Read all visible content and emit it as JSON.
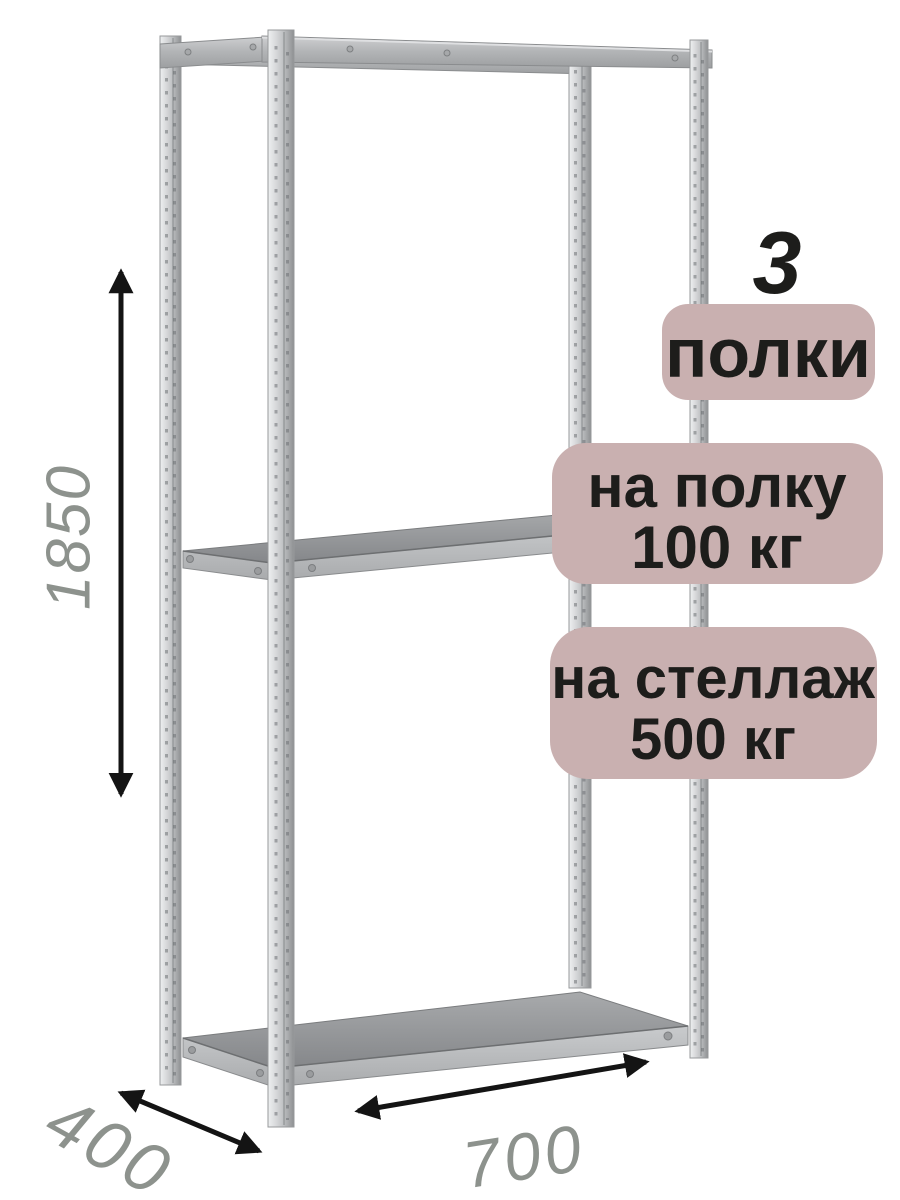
{
  "badges": {
    "count_number": "3",
    "count_label": "полки",
    "shelf_load_line1": "на полку",
    "shelf_load_line2": "100 кг",
    "rack_load_line1": "на стеллаж",
    "rack_load_line2": "500 кг",
    "bg_color": "#c9b0b0",
    "text_color": "#1d1d1b"
  },
  "dimensions": {
    "height": "1850",
    "depth": "400",
    "width": "700",
    "label_color": "#8d928d",
    "arrow_color": "#141414"
  },
  "rack": {
    "metal_light": "#d9dadc",
    "metal_shadow": "#97999b",
    "shelf_surface": "#8f9193",
    "shelf_edge": "#b7b9bb"
  }
}
